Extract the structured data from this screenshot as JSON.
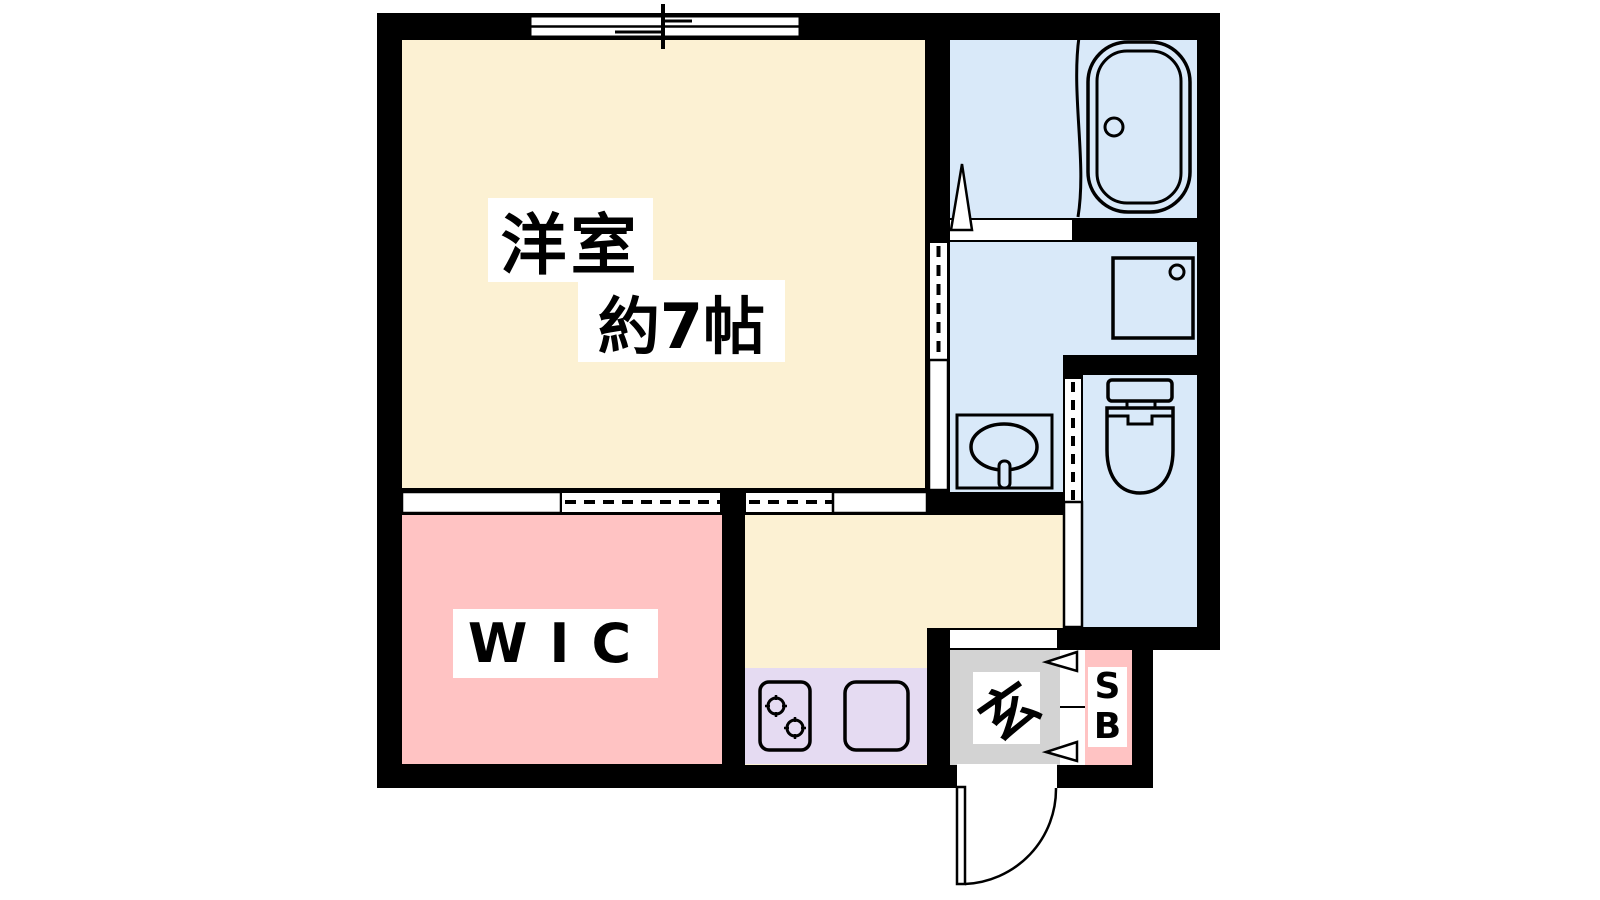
{
  "plan": {
    "type": "japanese-apartment-floor-plan",
    "background_color": "#FFFFFF",
    "wall_color": "#000000",
    "rooms": {
      "western_room": {
        "name_line1": "洋室",
        "name_line2": "約7帖",
        "floor_color": "#FCF1D3"
      },
      "wic": {
        "name": "WIC",
        "floor_color": "#FFC3C3"
      },
      "kitchen_hall": {
        "floor_color": "#FCF1D3",
        "counter_color": "#E5DBF2"
      },
      "bathroom": {
        "floor_color": "#D9E9F9"
      },
      "washroom": {
        "floor_color": "#D9E9F9"
      },
      "toilet_room": {
        "floor_color": "#D9E9F9"
      },
      "entrance": {
        "name": "玄",
        "floor_color": "#D3D3D3"
      },
      "shoe_box": {
        "name_line1": "S",
        "name_line2": "B",
        "floor_color": "#FFC3C3"
      }
    },
    "fixtures": [
      "sliding-window",
      "bathtub",
      "shower-door",
      "washing-machine-pan",
      "washbasin",
      "toilet",
      "two-burner-stove",
      "kitchen-sink",
      "sliding-doors",
      "entrance-swing-door",
      "shoe-box-doors"
    ]
  }
}
